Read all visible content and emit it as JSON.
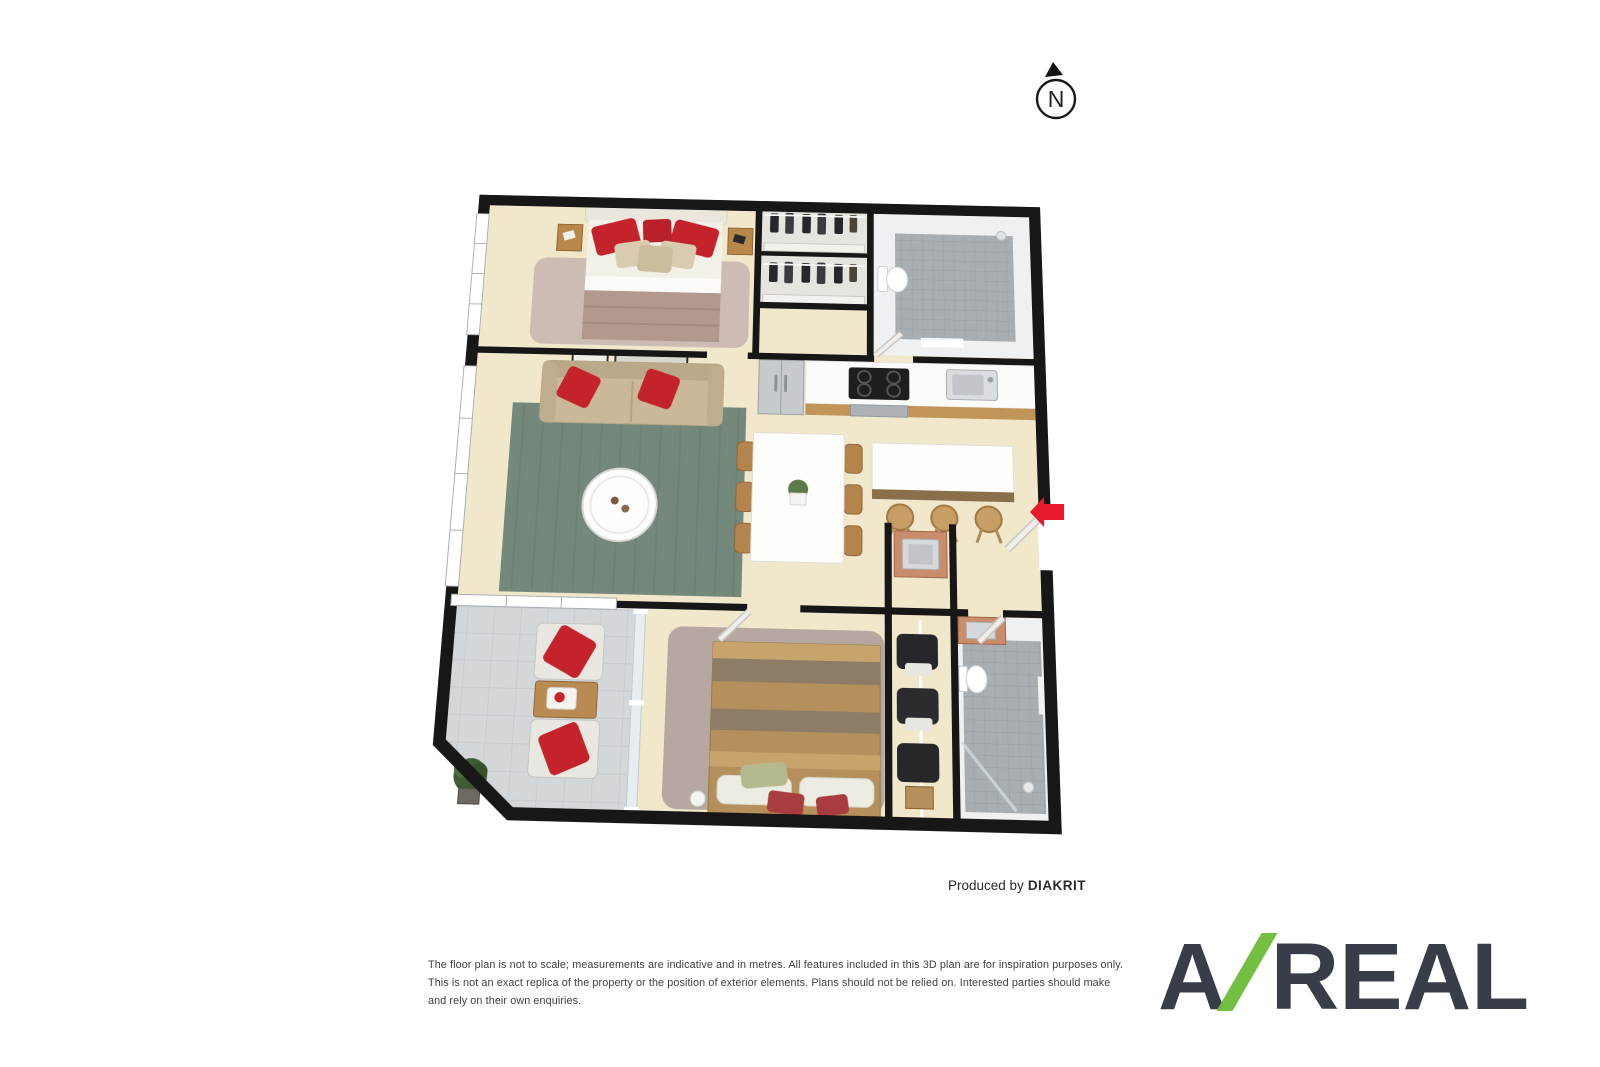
{
  "compass": {
    "label": "N"
  },
  "credit": {
    "prefix": "Produced by",
    "brand": "DIAKRIT"
  },
  "disclaimer": {
    "line1": "The floor plan is not to scale; measurements are indicative and in metres. All features included in this 3D plan are for inspiration purposes only.",
    "line2": "This is not an exact replica of the property or the position of exterior elements. Plans should not be relied on. Interested parties should make and rely on their own enquiries."
  },
  "logo": {
    "first": "A",
    "rest": "REAL",
    "dark_color": "#383d49",
    "green_color": "#72bf44"
  },
  "floor_plan": {
    "type": "3d-floor-plan",
    "rooms": [
      "bedroom-1",
      "wardrobes",
      "bathroom-1",
      "kitchen",
      "living-room",
      "dining-area",
      "kitchen-island",
      "entry",
      "balcony",
      "bedroom-2",
      "walk-in-robe",
      "laundry-nook",
      "bathroom-2"
    ],
    "colors": {
      "floor": "#f1e7cb",
      "walls": "#171717",
      "bathroom_tile": "#a9aeb3",
      "balcony_tile": "#d4d7da",
      "living_rug": "#75887c",
      "accent_red": "#c5232b",
      "wood": "#b98a52",
      "entry_arrow": "#e8192c"
    }
  }
}
